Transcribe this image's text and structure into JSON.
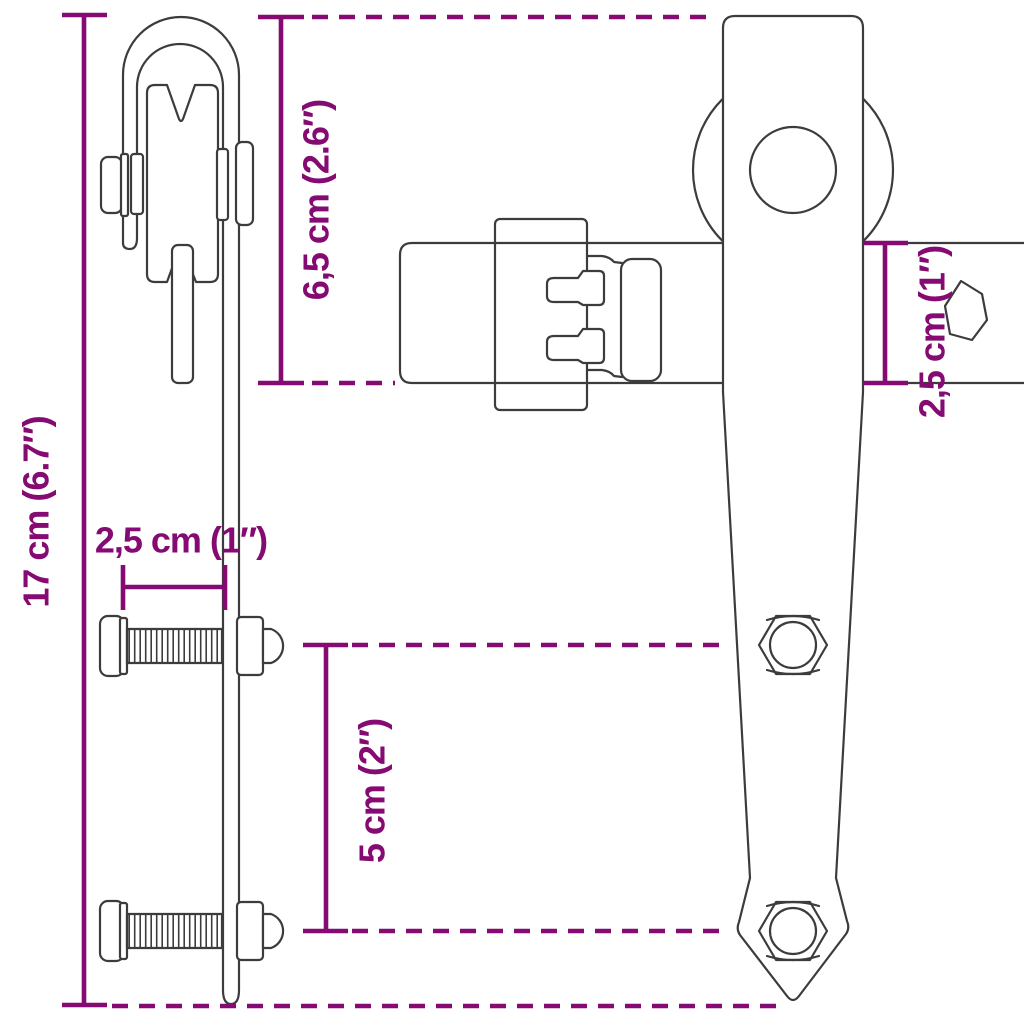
{
  "diagram": {
    "background_color": "#ffffff",
    "accent_color": "#850A72",
    "line_color": "#3c3c3c",
    "dimensions": {
      "total_height": {
        "label": "17 cm (6.7″)",
        "orientation": "vertical-left"
      },
      "hanger_height": {
        "label": "6,5 cm (2.6″)",
        "orientation": "vertical"
      },
      "bolt_offset": {
        "label": "2,5 cm (1″)",
        "orientation": "horizontal"
      },
      "hole_spacing": {
        "label": "5 cm (2″)",
        "orientation": "vertical"
      },
      "rail_height": {
        "label": "2,5 cm (1″)",
        "orientation": "vertical-right"
      }
    }
  }
}
